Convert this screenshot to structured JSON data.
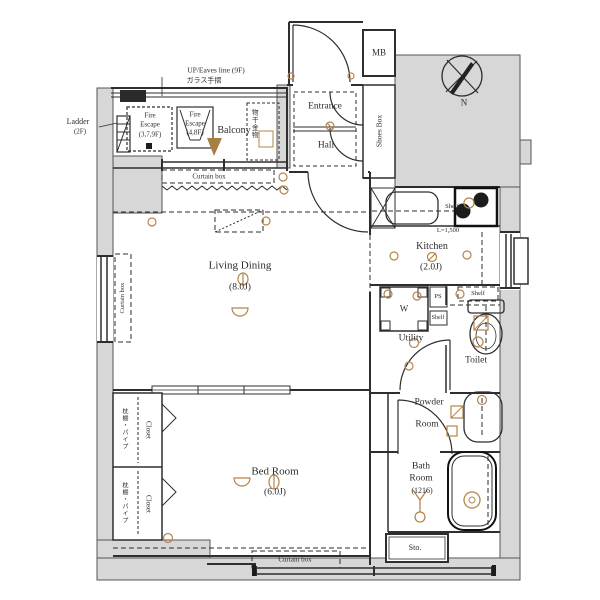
{
  "colors": {
    "wall_fill": "#d7d7d7",
    "line": "#2e2e2e",
    "accent": "#b5854b",
    "dark_fixture": "#1c1c1c"
  },
  "balcony": {
    "name": "Balcony",
    "up_eaves": "UP/Eaves line (9F)",
    "glass_rail": "ガラス手摺",
    "ladder": "Ladder",
    "ladder_floor": "(2F)",
    "laundry_hw": "物干金物",
    "fire_escape_a": {
      "l1": "Fire",
      "l2": "Escape",
      "l3": "(3,7,9F)"
    },
    "fire_escape_b": {
      "l1": "Fire",
      "l2": "Escape",
      "l3": "(4,8F)"
    }
  },
  "entrance": {
    "name": "Entrance",
    "hall": "Hall",
    "shoes_box": "Shoes Box",
    "mb": "MB"
  },
  "compass": {
    "north": "N"
  },
  "living": {
    "name": "Living Dining",
    "size": "(8.0J)",
    "curtain_box_top": "Curtain box",
    "curtain_box_left": "Curtain box"
  },
  "kitchen": {
    "name": "Kitchen",
    "size": "(2.0J)",
    "length": "L=1,500",
    "shelf": "Shelf"
  },
  "sanitary": {
    "washer": "W",
    "ps": "PS",
    "shelf_small": "Shelf",
    "shelf_toilet": "Shelf",
    "utility": "Utility",
    "toilet": "Toilet",
    "powder_l1": "Powder",
    "powder_l2": "Room",
    "bath_l1": "Bath",
    "bath_l2": "Room",
    "bath_size": "(1216)",
    "storage": "Sto."
  },
  "bedroom": {
    "name": "Bed Room",
    "size": "(6.0J)",
    "curtain_box": "Curtain box",
    "closet": "Closet",
    "closet_note": "枕棚・パイプ"
  }
}
